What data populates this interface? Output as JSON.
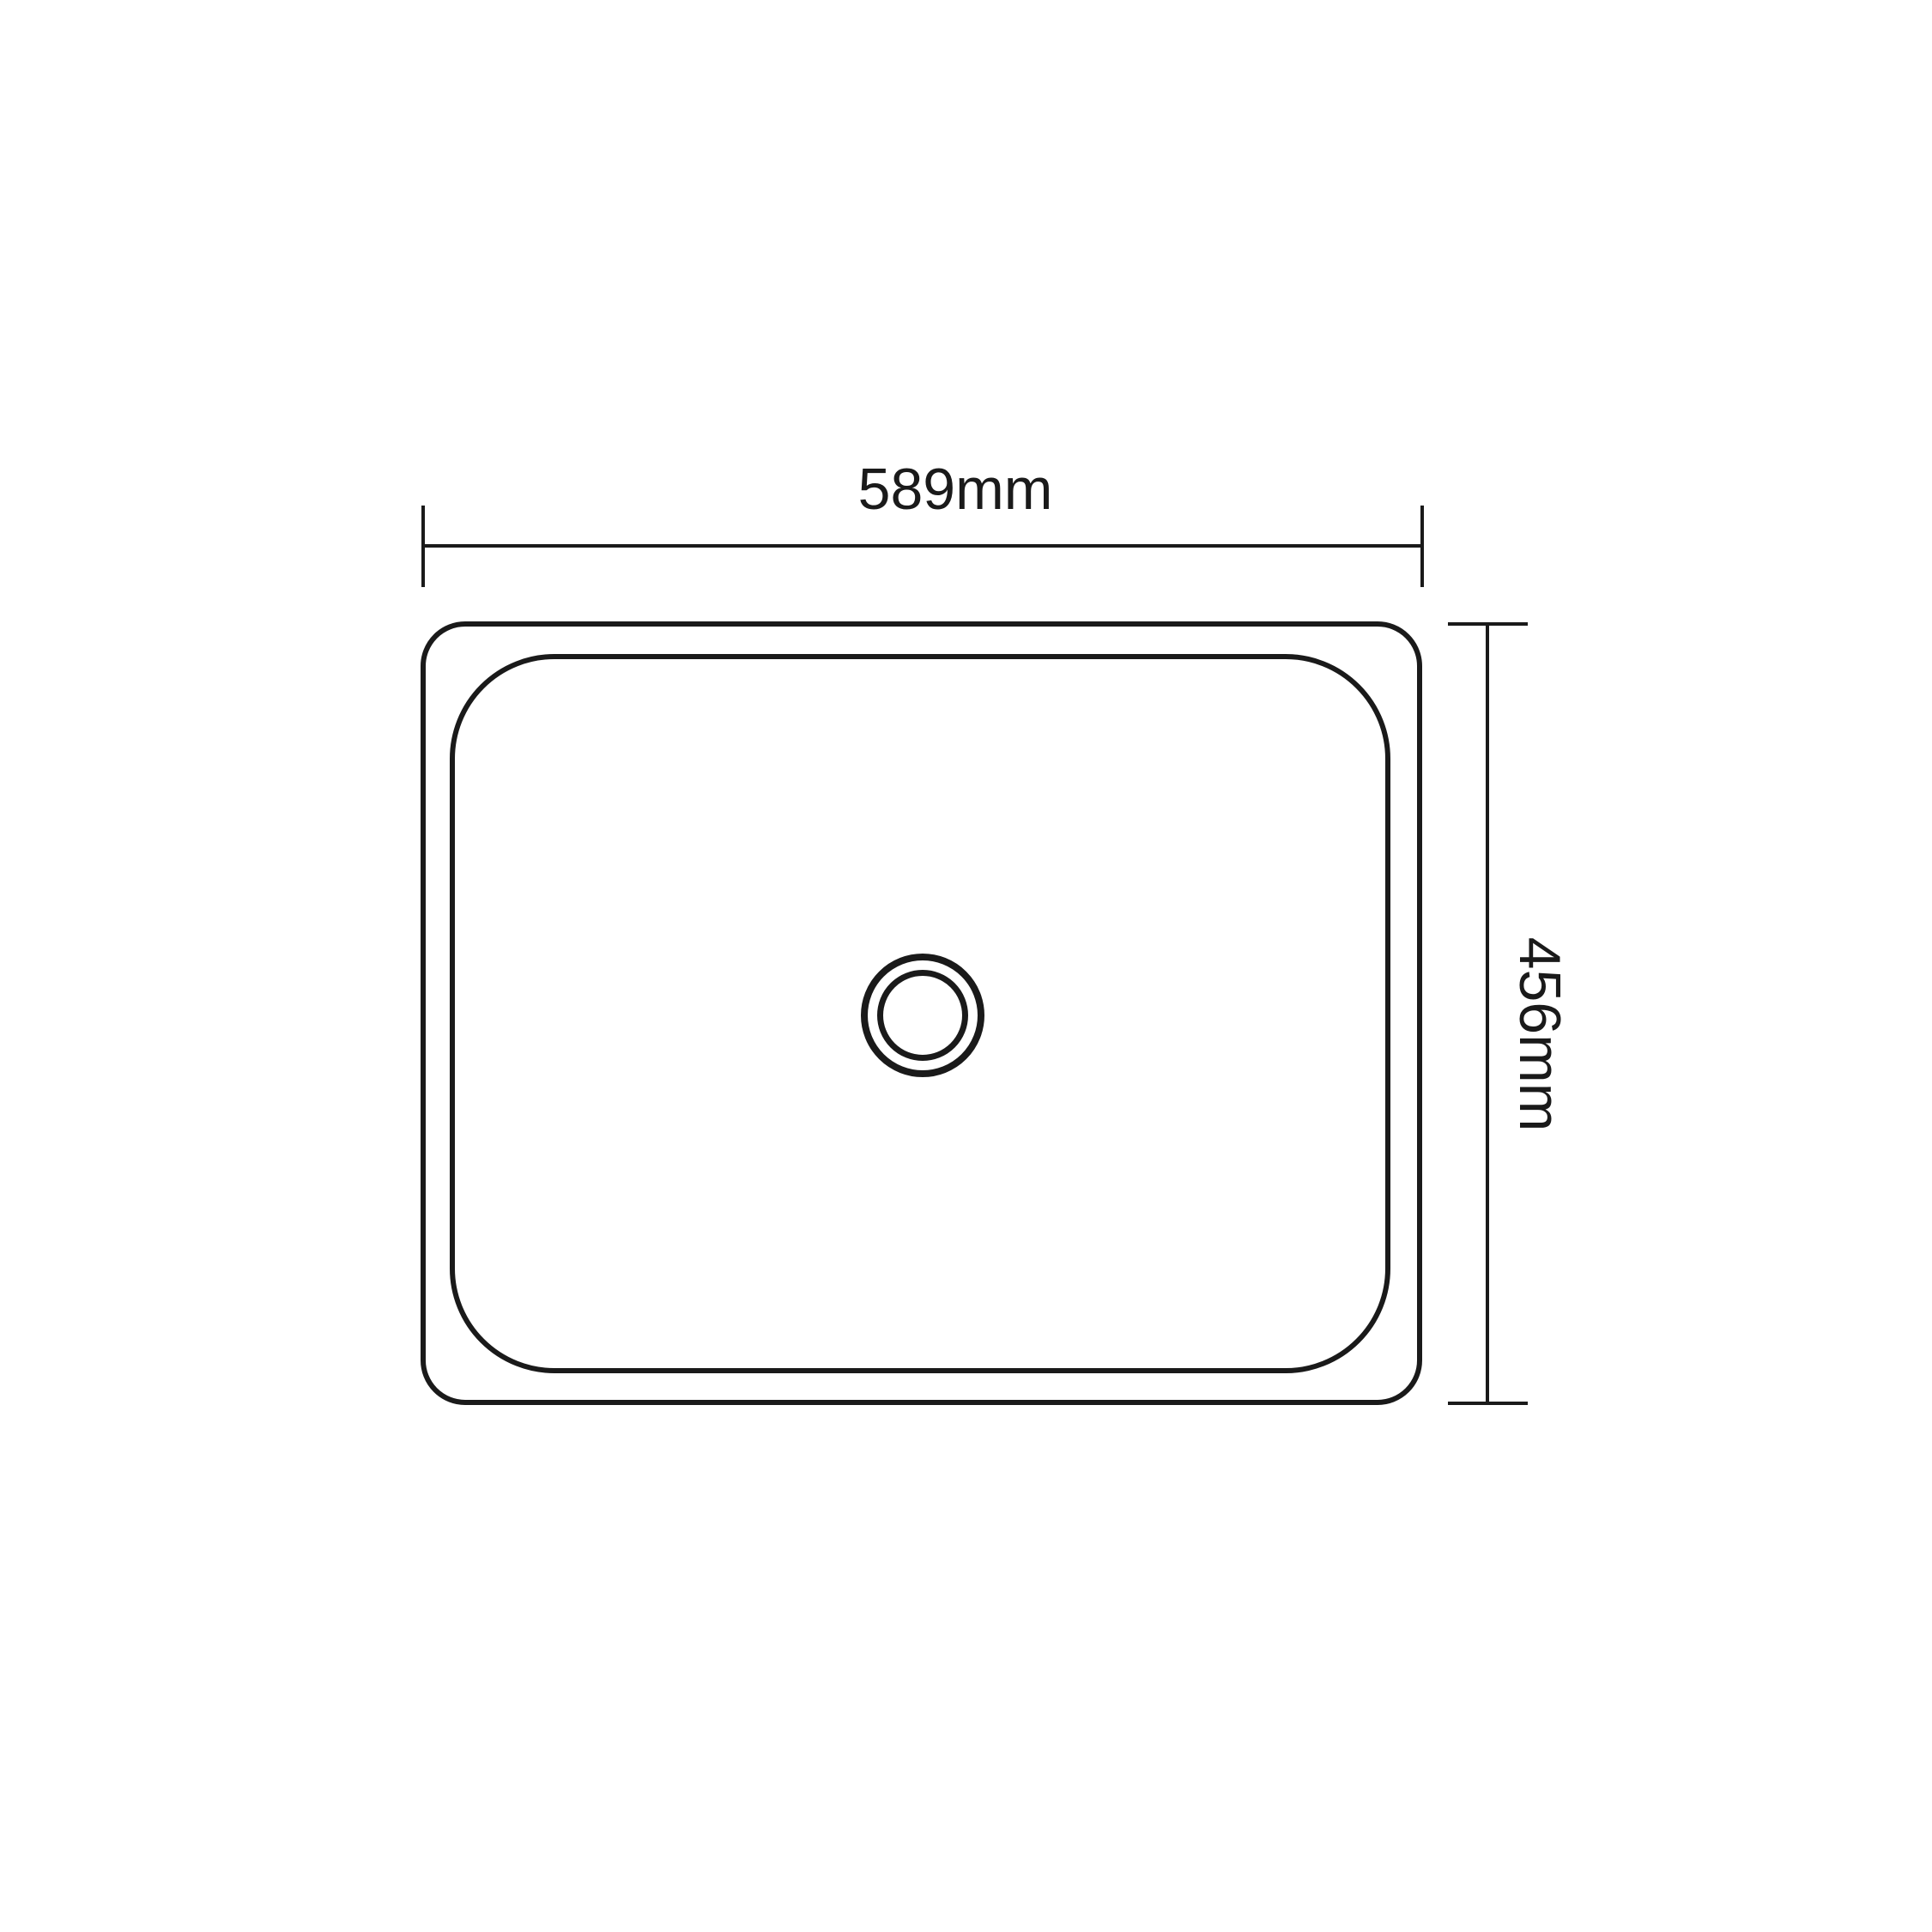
{
  "diagram": {
    "type": "technical-dimension-drawing",
    "subject": "rectangular sink top view with center drain",
    "background_color": "#ffffff",
    "line_color": "#1a1a1a",
    "dimensions": {
      "width_label": "589mm",
      "height_label": "456mm",
      "width_value_mm": 589,
      "height_value_mm": 456
    }
  }
}
